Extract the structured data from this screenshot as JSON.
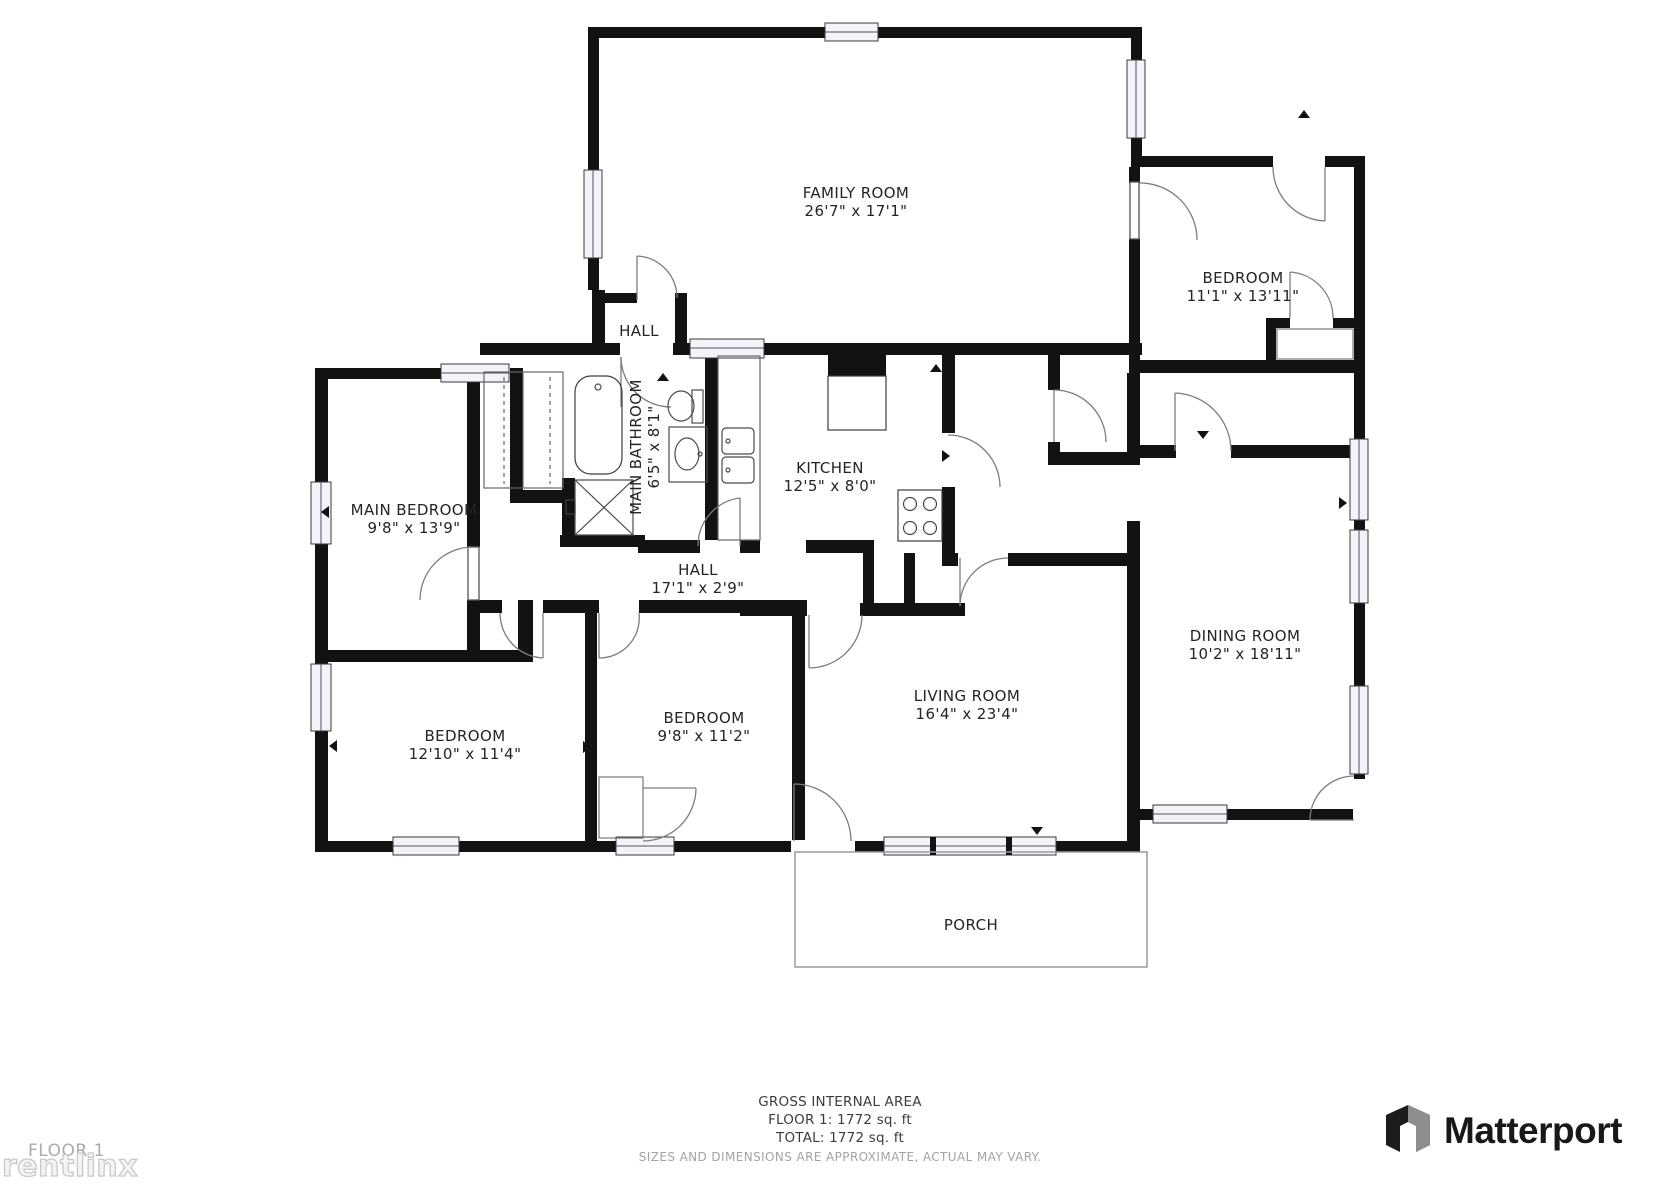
{
  "rooms": {
    "family": {
      "name": "FAMILY ROOM",
      "dims": "26'7\" x 17'1\""
    },
    "bedroom_ne": {
      "name": "BEDROOM",
      "dims": "11'1\" x 13'11\""
    },
    "main_bedroom": {
      "name": "MAIN BEDROOM",
      "dims": "9'8\" x 13'9\""
    },
    "main_bathroom": {
      "name": "MAIN BATHROOM",
      "dims": "6'5\" x 8'1\""
    },
    "kitchen": {
      "name": "KITCHEN",
      "dims": "12'5\" x 8'0\""
    },
    "hall_upper": {
      "name": "HALL"
    },
    "hall": {
      "name": "HALL",
      "dims": "17'1\" x 2'9\""
    },
    "dining": {
      "name": "DINING ROOM",
      "dims": "10'2\" x 18'11\""
    },
    "living": {
      "name": "LIVING ROOM",
      "dims": "16'4\" x 23'4\""
    },
    "bedroom_sw": {
      "name": "BEDROOM",
      "dims": "12'10\" x 11'4\""
    },
    "bedroom_s": {
      "name": "BEDROOM",
      "dims": "9'8\" x 11'2\""
    },
    "porch": {
      "name": "PORCH"
    }
  },
  "area_summary": {
    "title": "GROSS INTERNAL AREA",
    "floor1": "FLOOR 1: 1772 sq. ft",
    "total": "TOTAL: 1772 sq. ft",
    "disclaimer": "SIZES AND DIMENSIONS ARE APPROXIMATE, ACTUAL MAY VARY."
  },
  "branding": {
    "floor_label": "FLOOR 1",
    "watermark": "rentlinx",
    "logo_text": "Matterport"
  },
  "colors": {
    "wall": "#121212",
    "label": "#242424",
    "muted": "#a3a3a3",
    "logo": "#181818"
  }
}
